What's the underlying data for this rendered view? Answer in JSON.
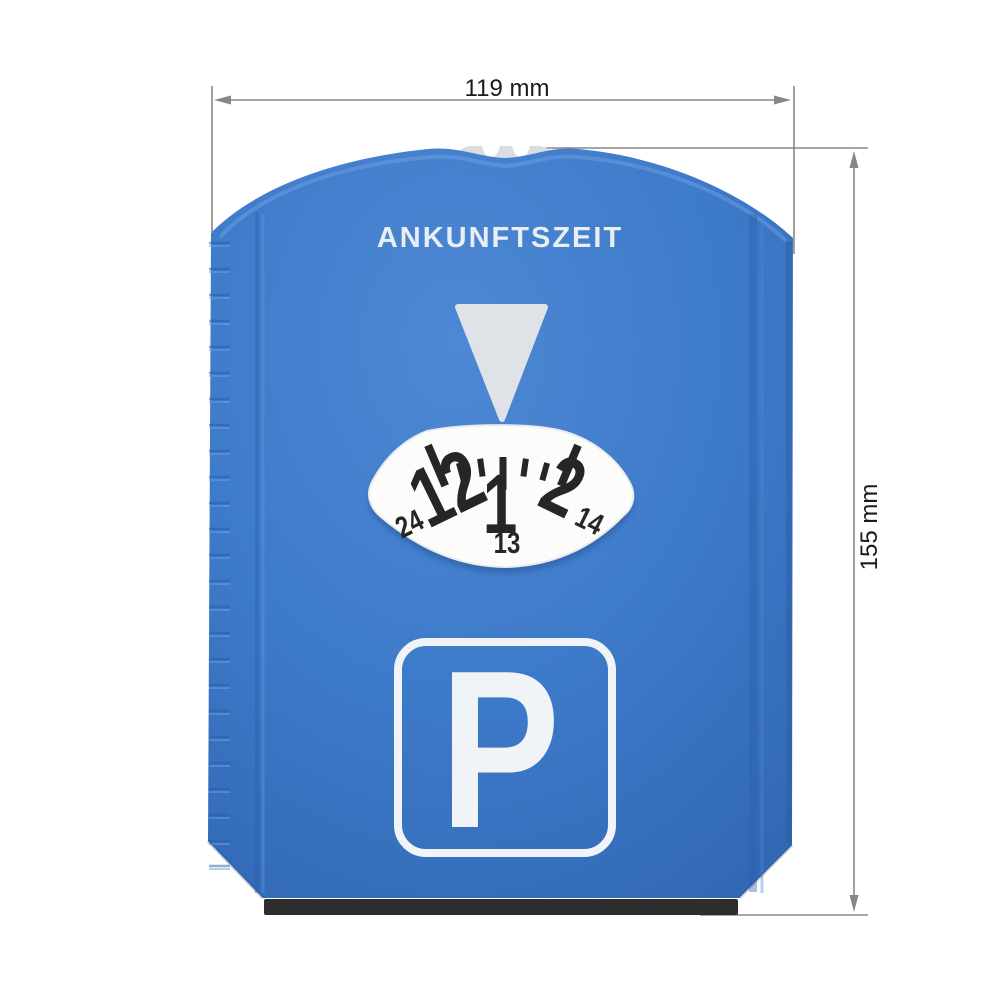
{
  "dimensions": {
    "width_label": "119 mm",
    "height_label": "155 mm",
    "line_color": "#878787",
    "text_color": "#1b1b1b"
  },
  "disc": {
    "header": "ANKUNFTSZEIT",
    "header_color": "#e9eef3",
    "body_color": "#3d7ac9",
    "body_highlight": "#4e88d4",
    "body_shadow": "#2f65b0",
    "knob_color": "#d9dde1",
    "scraper_lip_color": "#2d2d2d",
    "dial": {
      "pointer_color": "#dfe3e7",
      "window_color": "#fcfcfb",
      "numeral_color": "#262626",
      "hours": [
        "12",
        "1",
        "2"
      ],
      "sub_hours": [
        "24",
        "13",
        "14"
      ]
    },
    "sign": {
      "letter": "P",
      "color": "#f1f4f6"
    }
  }
}
